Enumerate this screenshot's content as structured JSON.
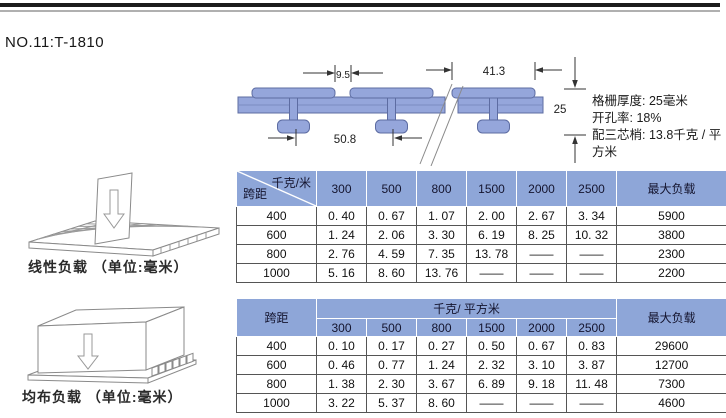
{
  "page": {
    "title": "NO.11:T-1810"
  },
  "specs": {
    "thickness": "格栅厚度: 25毫米",
    "open_rate": "开孔率: 18%",
    "weight": "配三芯梢: 13.8千克 / 平方米"
  },
  "diagram": {
    "dims": {
      "top_gap": "9.5",
      "flange_width": "41.3",
      "thickness": "25",
      "pitch": "50.8"
    }
  },
  "pictograms": {
    "linear_caption": "线性负载 （单位:毫米）",
    "uniform_caption": "均布负载 （单位:毫米）"
  },
  "table1": {
    "corner_top_label": "千克/米",
    "corner_bottom_label": "跨距",
    "columns": [
      "300",
      "500",
      "800",
      "1500",
      "2000",
      "2500"
    ],
    "max_label": "最大负载",
    "rows": [
      {
        "span": "400",
        "values": [
          "0. 40",
          "0. 67",
          "1. 07",
          "2. 00",
          "2. 67",
          "3. 34"
        ],
        "max": "5900"
      },
      {
        "span": "600",
        "values": [
          "1. 24",
          "2. 06",
          "3. 30",
          "6. 19",
          "8. 25",
          "10. 32"
        ],
        "max": "3800"
      },
      {
        "span": "800",
        "values": [
          "2. 76",
          "4. 59",
          "7. 35",
          "13. 78",
          "——",
          "——"
        ],
        "max": "2300"
      },
      {
        "span": "1000",
        "values": [
          "5. 16",
          "8. 60",
          "13. 76",
          "——",
          "——",
          "——"
        ],
        "max": "2200"
      }
    ]
  },
  "table2": {
    "span_label": "跨距",
    "unit_label": "千克/ 平方米",
    "columns": [
      "300",
      "500",
      "800",
      "1500",
      "2000",
      "2500"
    ],
    "max_label": "最大负载",
    "rows": [
      {
        "span": "400",
        "values": [
          "0. 10",
          "0. 17",
          "0. 27",
          "0. 50",
          "0. 67",
          "0. 83"
        ],
        "max": "29600"
      },
      {
        "span": "600",
        "values": [
          "0. 46",
          "0. 77",
          "1. 24",
          "2. 32",
          "3. 10",
          "3. 87"
        ],
        "max": "12700"
      },
      {
        "span": "800",
        "values": [
          "1. 38",
          "2. 30",
          "3. 67",
          "6. 89",
          "9. 18",
          "11. 48"
        ],
        "max": "7300"
      },
      {
        "span": "1000",
        "values": [
          "3. 22",
          "5. 37",
          "8. 60",
          "——",
          "——",
          "——"
        ],
        "max": "4600"
      }
    ]
  },
  "colors": {
    "header_blue": "#8ea6d8",
    "profile_fill": "#95a6db",
    "profile_stroke": "#5d6ca2"
  }
}
